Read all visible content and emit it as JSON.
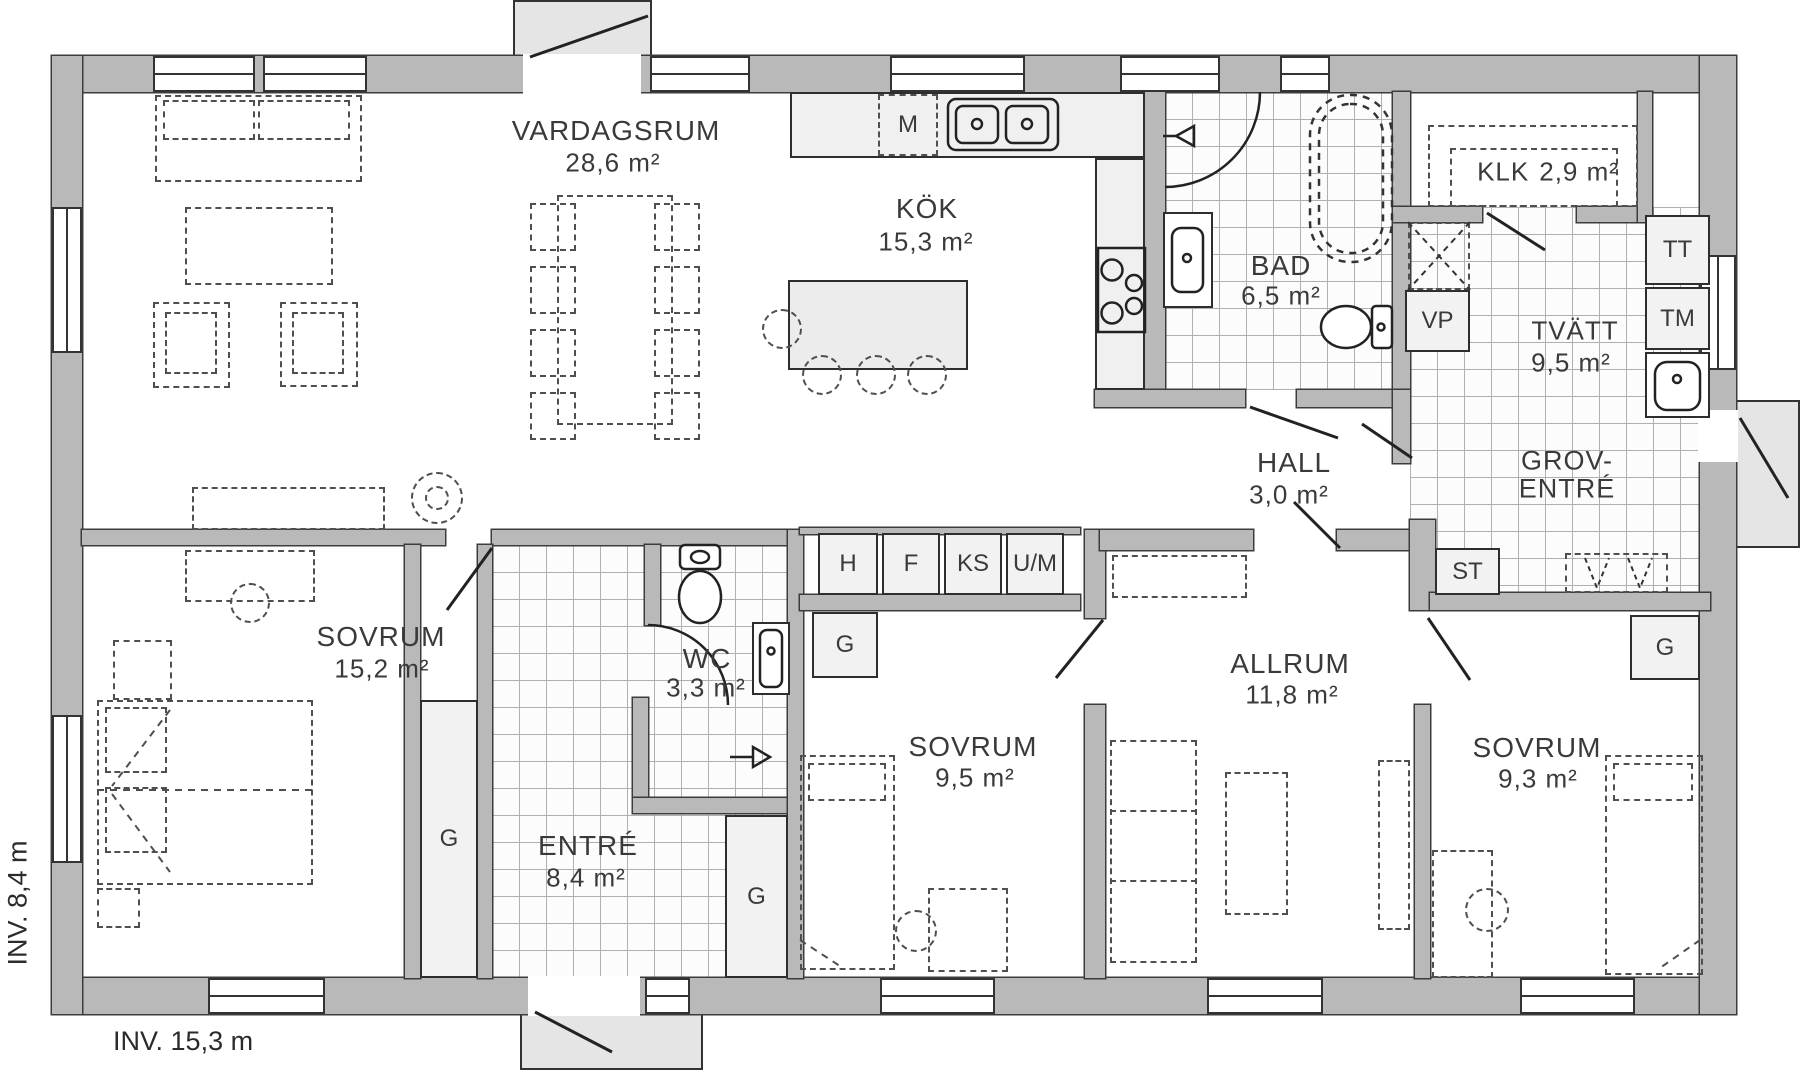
{
  "rooms": {
    "vardagsrum": {
      "name": "VARDAGSRUM",
      "area": "28,6 m²"
    },
    "kok": {
      "name": "KÖK",
      "area": "15,3 m²"
    },
    "bad": {
      "name": "BAD",
      "area": "6,5 m²"
    },
    "klk": {
      "name": "KLK",
      "area": "2,9 m²"
    },
    "tvatt": {
      "name": "TVÄTT",
      "area": "9,5 m²"
    },
    "hall": {
      "name": "HALL",
      "area": "3,0 m²"
    },
    "groventre": {
      "name_line1": "GROV-",
      "name_line2": "ENTRÉ"
    },
    "sovrum_vanster": {
      "name": "SOVRUM",
      "area": "15,2 m²"
    },
    "entre": {
      "name": "ENTRÉ",
      "area": "8,4 m²"
    },
    "wc": {
      "name": "WC",
      "area": "3,3 m²"
    },
    "sovrum_mitt": {
      "name": "SOVRUM",
      "area": "9,5 m²"
    },
    "allrum": {
      "name": "ALLRUM",
      "area": "11,8 m²"
    },
    "sovrum_oster": {
      "name": "SOVRUM",
      "area": "9,3 m²"
    }
  },
  "storage_labels": {
    "g": "G",
    "st": "ST",
    "vp": "VP",
    "m": "M"
  },
  "appliance_labels": {
    "h": "H",
    "f": "F",
    "ks": "KS",
    "um": "U/M",
    "tt": "TT",
    "tm": "TM"
  },
  "dimensions": {
    "interior_width": "INV. 15,3 m",
    "interior_height": "INV. 8,4 m"
  },
  "colors": {
    "wall_fill": "#b9b9b9",
    "outline": "#333333",
    "porch_fill": "#e5e5e5",
    "closet_fill": "#f2f2f2",
    "tile_line": "#b0b0b0",
    "text": "#3a3a3a"
  }
}
